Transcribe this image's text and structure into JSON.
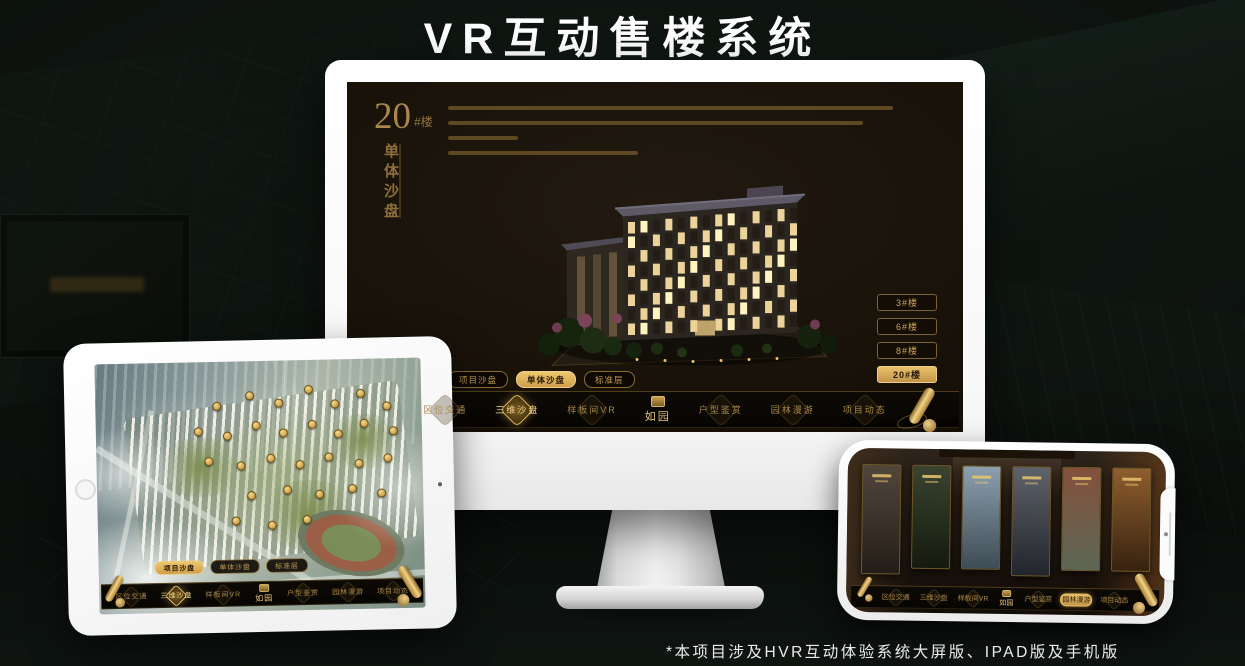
{
  "page": {
    "title": "VR互动售楼系统",
    "footnote": "*本项目涉及HVR互动体验系统大屏版、IPAD版及手机版"
  },
  "brand": {
    "logo_text": "如园"
  },
  "colors": {
    "accent_gold": "#d2a855",
    "active_tab_gold": "#d8a94f",
    "screen_dark": "#171108",
    "title_white": "#ffffff"
  },
  "icons": {
    "scroll": "gold-scroll-icon",
    "logo_seal": "brand-seal-icon",
    "building_marker": "gold-building-badge"
  },
  "monitor": {
    "headline": {
      "number": "20",
      "suffix": "#楼",
      "subtitle": "单体沙盘"
    },
    "floor_buttons": [
      {
        "label": "3#楼",
        "active": false
      },
      {
        "label": "6#楼",
        "active": false
      },
      {
        "label": "8#楼",
        "active": false
      },
      {
        "label": "20#楼",
        "active": true
      }
    ],
    "view_tabs": [
      {
        "label": "项目沙盘",
        "active": false
      },
      {
        "label": "单体沙盘",
        "active": true
      },
      {
        "label": "标准层",
        "active": false
      }
    ],
    "nav_left": [
      {
        "label": "区位交通",
        "active": false
      },
      {
        "label": "三维沙盘",
        "active": true
      },
      {
        "label": "样板间VR",
        "active": false
      }
    ],
    "nav_right": [
      {
        "label": "户型鉴赏",
        "active": false
      },
      {
        "label": "园林漫游",
        "active": false
      },
      {
        "label": "项目动态",
        "active": false
      }
    ]
  },
  "tablet": {
    "view_tabs": [
      {
        "label": "项目沙盘",
        "active": true
      },
      {
        "label": "单体沙盘",
        "active": false
      },
      {
        "label": "标准层",
        "active": false
      }
    ],
    "nav_left": [
      {
        "label": "区位交通",
        "active": false
      },
      {
        "label": "三维沙盘",
        "active": true
      },
      {
        "label": "样板间VR",
        "active": false
      }
    ],
    "nav_right": [
      {
        "label": "户型鉴赏",
        "active": false
      },
      {
        "label": "园林漫游",
        "active": false
      },
      {
        "label": "项目动态",
        "active": false
      }
    ],
    "aerial": {
      "markers": [
        [
          36,
          16
        ],
        [
          46,
          12
        ],
        [
          55,
          15
        ],
        [
          64,
          10
        ],
        [
          72,
          16
        ],
        [
          80,
          12
        ],
        [
          88,
          17
        ],
        [
          30,
          26
        ],
        [
          39,
          28
        ],
        [
          48,
          24
        ],
        [
          56,
          27
        ],
        [
          65,
          24
        ],
        [
          73,
          28
        ],
        [
          81,
          24
        ],
        [
          90,
          27
        ],
        [
          33,
          38
        ],
        [
          43,
          40
        ],
        [
          52,
          37
        ],
        [
          61,
          40
        ],
        [
          70,
          37
        ],
        [
          79,
          40
        ],
        [
          88,
          38
        ],
        [
          46,
          52
        ],
        [
          57,
          50
        ],
        [
          67,
          52
        ],
        [
          77,
          50
        ],
        [
          86,
          52
        ],
        [
          41,
          62
        ],
        [
          52,
          64
        ],
        [
          63,
          62
        ]
      ]
    }
  },
  "phone": {
    "nav_left": [
      {
        "label": "区位交通",
        "active": false
      },
      {
        "label": "三维沙盘",
        "active": false
      },
      {
        "label": "样板间VR",
        "active": false
      }
    ],
    "nav_right": [
      {
        "label": "户型鉴赏",
        "active": false
      },
      {
        "label": "园林漫游",
        "active": true
      },
      {
        "label": "项目动态",
        "active": false
      }
    ],
    "panels": [
      {
        "name": "courtyard-interior",
        "top": "#52463c",
        "bottom": "#241e18"
      },
      {
        "name": "garden-night",
        "top": "#3a4430",
        "bottom": "#141a0e"
      },
      {
        "name": "tower-daylight",
        "top": "#8ba0b0",
        "bottom": "#3e4c54"
      },
      {
        "name": "building-facade",
        "top": "#5e626a",
        "bottom": "#22252b"
      },
      {
        "name": "autumn-court",
        "top": "#84503c",
        "bottom": "#5c6854"
      },
      {
        "name": "wooden-shelf",
        "top": "#8e5e2e",
        "bottom": "#372210"
      }
    ]
  }
}
